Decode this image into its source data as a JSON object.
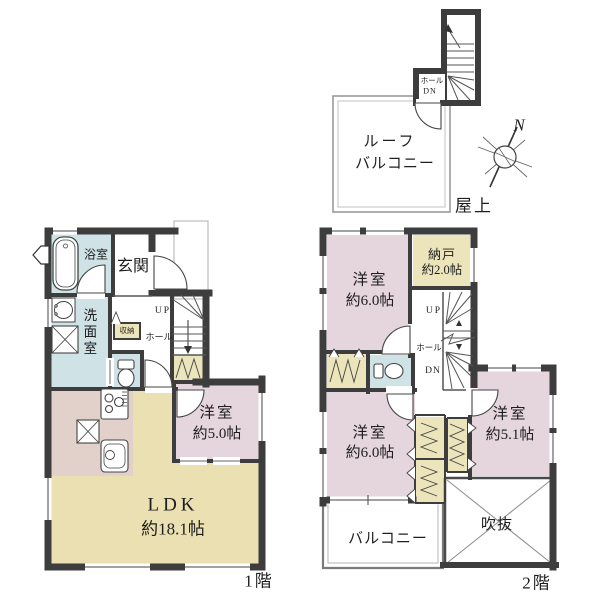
{
  "colors": {
    "wall": "#3d3d3d",
    "room_pink": "#e5d5dd",
    "room_yellow": "#eae0b2",
    "room_blue": "#cfe2e6",
    "room_beige": "#e1d1ca",
    "closet_yellow": "#ece4bb"
  },
  "floor1": {
    "floor_label": "1階",
    "bath": "浴室",
    "entrance": "玄関",
    "washroom": "洗面室",
    "storage": "収納",
    "hall": "ホール",
    "up": "UP",
    "west_room": {
      "name": "洋室",
      "size": "約5.0帖"
    },
    "ldk": {
      "name": "LDK",
      "size": "約18.1帖"
    }
  },
  "floor2": {
    "floor_label": "2階",
    "west_room_top": {
      "name": "洋室",
      "size": "約6.0帖"
    },
    "storage_room": {
      "name": "納戸",
      "size": "約2.0帖"
    },
    "up": "UP",
    "hall": "ホール",
    "dn": "DN",
    "west_room_bottom": {
      "name": "洋室",
      "size": "約6.0帖"
    },
    "west_room_right": {
      "name": "洋室",
      "size": "約5.1帖"
    },
    "void": "吹抜",
    "balcony": "バルコニー"
  },
  "roof": {
    "area_label": "屋上",
    "hall": "ホール",
    "dn": "DN",
    "balcony_line1": "ルーフ",
    "balcony_line2": "バルコニー"
  },
  "compass": {
    "north": "N"
  }
}
